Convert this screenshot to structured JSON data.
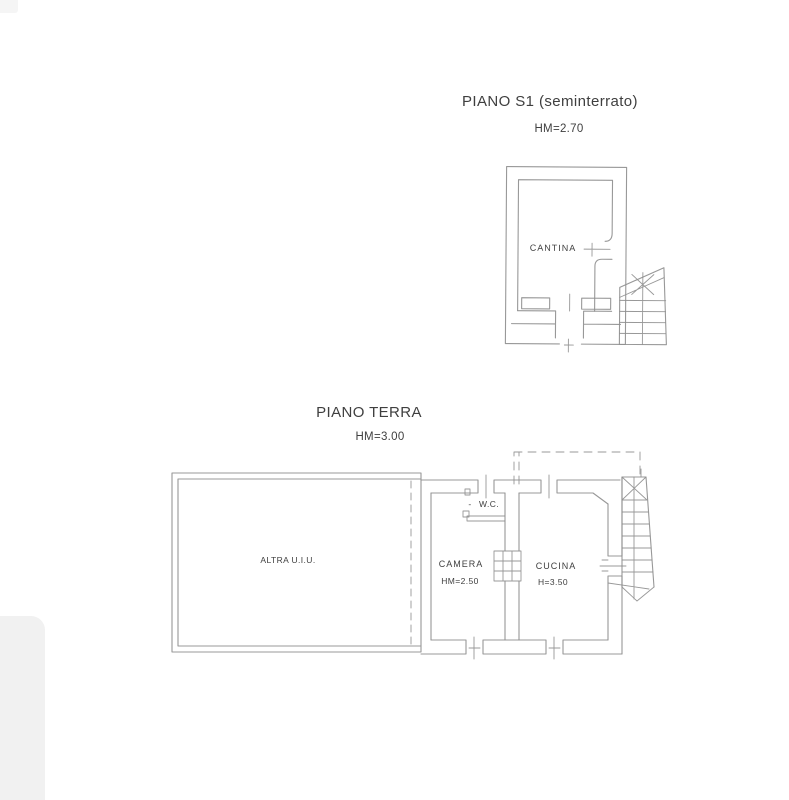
{
  "document": {
    "type": "scanned floor plan (planimetria catastale)"
  },
  "colors": {
    "background": "#ffffff",
    "line": "#8f8f8f",
    "text": "#3f3f3f",
    "artifact": "#f1f1f1"
  },
  "floor_s1": {
    "title": "PIANO S1 (seminterrato)",
    "height_label": "HM=2.70",
    "rooms": {
      "cantina": "CANTINA"
    }
  },
  "floor_terra": {
    "title": "PIANO TERRA",
    "height_label": "HM=3.00",
    "rooms": {
      "altra": "ALTRA U.I.U.",
      "camera": "CAMERA",
      "camera_height": "HM=2.50",
      "wc_dash": "-",
      "wc": "W.C.",
      "cucina": "CUCINA",
      "cucina_height": "H=3.50"
    }
  }
}
